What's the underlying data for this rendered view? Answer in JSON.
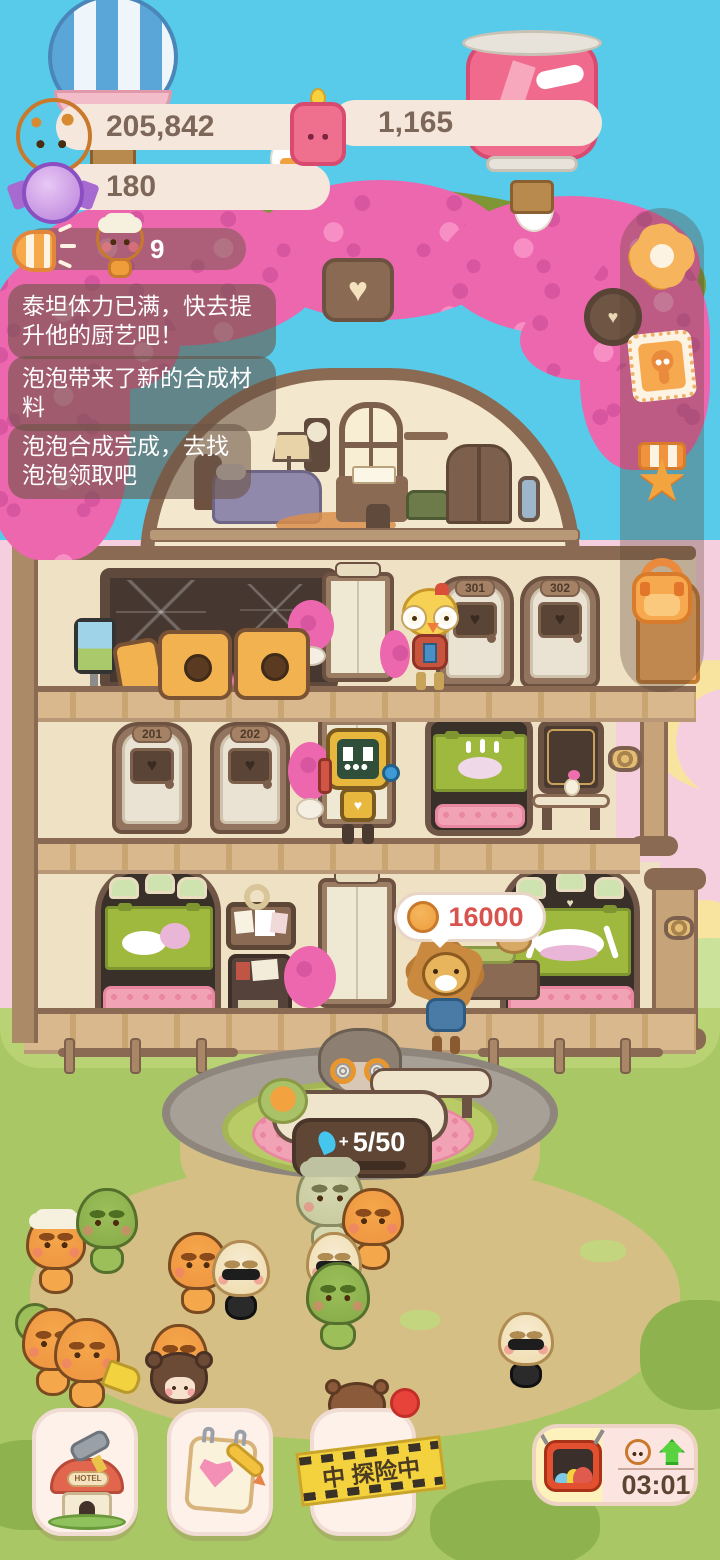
{
  "hud": {
    "currencies": {
      "cookies": "205,842",
      "candles": "1,165",
      "candies": "180"
    },
    "announcement_count": "9",
    "toasts": [
      "泰坦体力已满，快去提升他的厨艺吧！",
      "泡泡带来了新的合成材料",
      "泡泡合成完成，去找泡泡领取吧"
    ],
    "side_menu": [
      "gear-flower",
      "ghost-stamp",
      "star-medal",
      "backpack"
    ]
  },
  "hotel": {
    "rooms": {
      "r301": "301",
      "r302": "302",
      "r201": "201",
      "r202": "202"
    },
    "price_tag": "16000",
    "reception": {
      "plus": "+",
      "progress": "5/50",
      "progress_percent": 24
    }
  },
  "footer": {
    "hotel_sign": "HOTEL",
    "adventure_banner": "中 探险中",
    "timer": "03:01"
  },
  "colors": {
    "sky": "#57cbe9",
    "flower_pink": "#ec67ad",
    "ui_orange": "#f5a94b",
    "accent_red": "#e2574c",
    "grass": "#aac766"
  }
}
